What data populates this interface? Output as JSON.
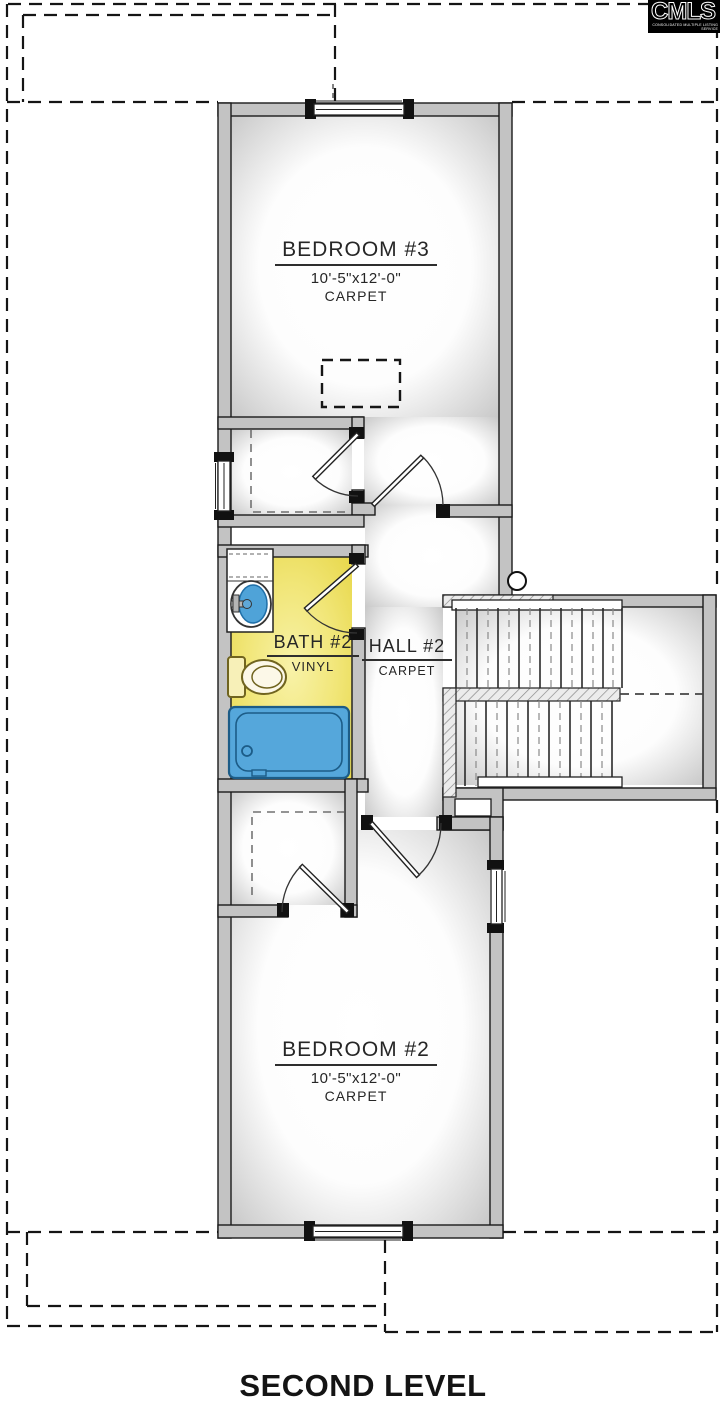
{
  "logo": {
    "brand": "CMLS",
    "tagline": "CONSOLIDATED MULTIPLE LISTING SERVICE"
  },
  "title": "SECOND LEVEL",
  "rooms": {
    "bedroom3": {
      "name": "BEDROOM #3",
      "dims": "10'-5\"x12'-0\"",
      "floor": "CARPET"
    },
    "bath2": {
      "name": "BATH #2",
      "floor": "VINYL"
    },
    "hall2": {
      "name": "HALL #2",
      "floor": "CARPET"
    },
    "bedroom2": {
      "name": "BEDROOM #2",
      "dims": "10'-5\"x12'-0\"",
      "floor": "CARPET"
    }
  },
  "colors": {
    "wall": "#c3c3c3",
    "bath_fill": "#eadd55",
    "fixture_blue": "#55a7db",
    "toilet_outline": "#70641f",
    "text": "#262626",
    "logo_bg": "#000000"
  }
}
